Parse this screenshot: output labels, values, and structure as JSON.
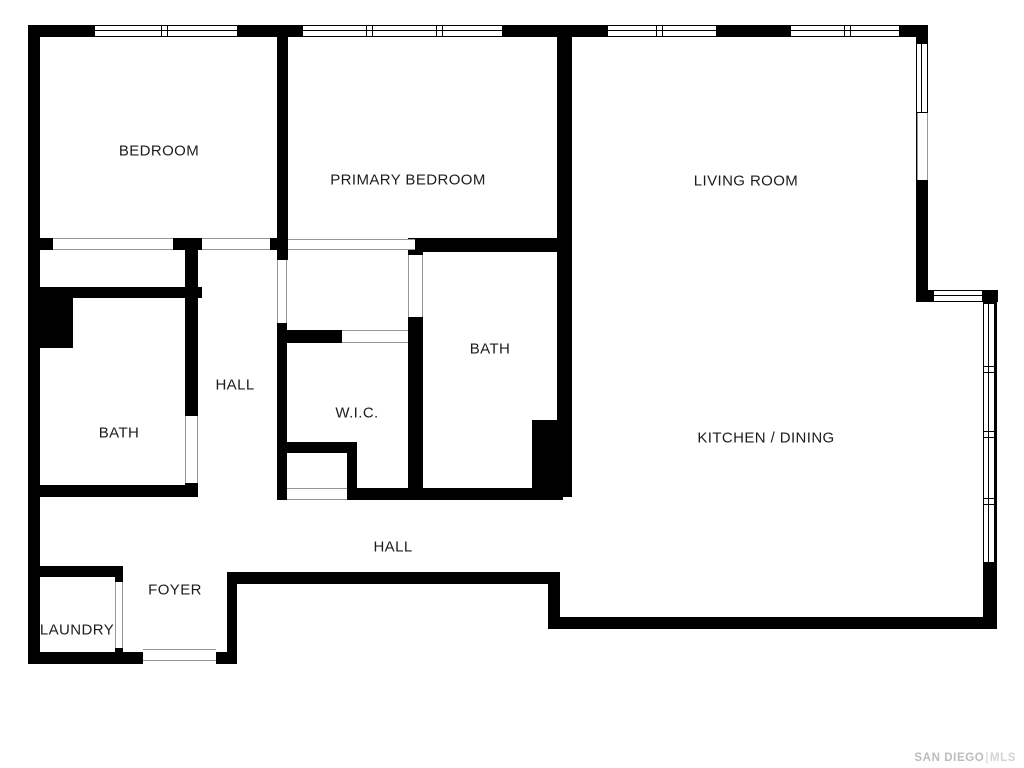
{
  "title": "Floor plan",
  "colors": {
    "wall": "#000000",
    "background": "#ffffff",
    "label_text": "#1c1c1c",
    "opening_line": "#979797",
    "watermark_brand": "#bcbcbc",
    "watermark_separator": "#cccccc",
    "watermark_suffix": "#d4d4d4"
  },
  "watermark": {
    "brand": "SAN DIEGO",
    "separator": "|",
    "suffix": "MLS"
  },
  "plan": {
    "width": 1024,
    "height": 768,
    "rooms": [
      {
        "name": "bedroom",
        "label": "BEDROOM",
        "cx": 159,
        "cy": 151
      },
      {
        "name": "primary-bedroom",
        "label": "PRIMARY BEDROOM",
        "cx": 408,
        "cy": 180
      },
      {
        "name": "living-room",
        "label": "LIVING ROOM",
        "cx": 746,
        "cy": 181
      },
      {
        "name": "bath-middle",
        "label": "BATH",
        "cx": 490,
        "cy": 349
      },
      {
        "name": "hall-upper",
        "label": "HALL",
        "cx": 235,
        "cy": 385
      },
      {
        "name": "wic",
        "label": "W.I.C.",
        "cx": 357,
        "cy": 413
      },
      {
        "name": "bath-left",
        "label": "BATH",
        "cx": 119,
        "cy": 433
      },
      {
        "name": "kitchen-dining",
        "label": "KITCHEN / DINING",
        "cx": 766,
        "cy": 438
      },
      {
        "name": "hall-lower",
        "label": "HALL",
        "cx": 393,
        "cy": 547
      },
      {
        "name": "foyer",
        "label": "FOYER",
        "cx": 175,
        "cy": 590
      },
      {
        "name": "laundry",
        "label": "LAUNDRY",
        "cx": 77,
        "cy": 630
      }
    ],
    "walls": [
      {
        "x": 28,
        "y": 25,
        "w": 900,
        "h": 12
      },
      {
        "x": 28,
        "y": 25,
        "w": 12,
        "h": 639
      },
      {
        "x": 916,
        "y": 25,
        "w": 12,
        "h": 268
      },
      {
        "x": 916,
        "y": 290,
        "w": 82,
        "h": 12
      },
      {
        "x": 983,
        "y": 290,
        "w": 14,
        "h": 339
      },
      {
        "x": 548,
        "y": 617,
        "w": 449,
        "h": 12
      },
      {
        "x": 548,
        "y": 572,
        "w": 12,
        "h": 57
      },
      {
        "x": 227,
        "y": 572,
        "w": 333,
        "h": 12
      },
      {
        "x": 227,
        "y": 572,
        "w": 10,
        "h": 92
      },
      {
        "x": 216,
        "y": 652,
        "w": 21,
        "h": 12
      },
      {
        "x": 28,
        "y": 652,
        "w": 115,
        "h": 12
      },
      {
        "x": 115,
        "y": 566,
        "w": 8,
        "h": 98
      },
      {
        "x": 28,
        "y": 566,
        "w": 95,
        "h": 11
      },
      {
        "x": 277,
        "y": 25,
        "w": 11,
        "h": 235
      },
      {
        "x": 28,
        "y": 238,
        "w": 260,
        "h": 12
      },
      {
        "x": 185,
        "y": 250,
        "w": 13,
        "h": 166
      },
      {
        "x": 185,
        "y": 483,
        "w": 13,
        "h": 14
      },
      {
        "x": 28,
        "y": 287,
        "w": 174,
        "h": 11
      },
      {
        "x": 28,
        "y": 287,
        "w": 45,
        "h": 61
      },
      {
        "x": 28,
        "y": 485,
        "w": 170,
        "h": 12
      },
      {
        "x": 277,
        "y": 323,
        "w": 10,
        "h": 175
      },
      {
        "x": 287,
        "y": 330,
        "w": 133,
        "h": 13
      },
      {
        "x": 287,
        "y": 442,
        "w": 70,
        "h": 11
      },
      {
        "x": 347,
        "y": 442,
        "w": 10,
        "h": 58
      },
      {
        "x": 277,
        "y": 488,
        "w": 286,
        "h": 12
      },
      {
        "x": 408,
        "y": 238,
        "w": 15,
        "h": 262
      },
      {
        "x": 415,
        "y": 238,
        "w": 155,
        "h": 14
      },
      {
        "x": 557,
        "y": 25,
        "w": 15,
        "h": 472
      },
      {
        "x": 532,
        "y": 420,
        "w": 25,
        "h": 77
      }
    ],
    "windows": [
      {
        "x": 94,
        "y": 25,
        "w": 144,
        "h": 12,
        "mullions": [
          69
        ]
      },
      {
        "x": 302,
        "y": 25,
        "w": 201,
        "h": 12,
        "mullions": [
          66,
          136
        ]
      },
      {
        "x": 607,
        "y": 25,
        "w": 110,
        "h": 12,
        "mullions": [
          51
        ]
      },
      {
        "x": 790,
        "y": 25,
        "w": 110,
        "h": 12,
        "mullions": [
          56
        ]
      },
      {
        "x": 916,
        "y": 43,
        "w": 12,
        "h": 70,
        "mullions": []
      },
      {
        "x": 933,
        "y": 290,
        "w": 50,
        "h": 12,
        "mullions": []
      },
      {
        "x": 983,
        "y": 303,
        "w": 12,
        "h": 260,
        "mullions": [
          65,
          130,
          197
        ]
      }
    ],
    "openings": [
      {
        "x": 53,
        "y": 238,
        "w": 120,
        "h": 12,
        "o": "h"
      },
      {
        "x": 202,
        "y": 238,
        "w": 68,
        "h": 12,
        "o": "h"
      },
      {
        "x": 288,
        "y": 239,
        "w": 127,
        "h": 11,
        "o": "h"
      },
      {
        "x": 277,
        "y": 260,
        "w": 10,
        "h": 63,
        "o": "v"
      },
      {
        "x": 408,
        "y": 255,
        "w": 15,
        "h": 62,
        "o": "v"
      },
      {
        "x": 342,
        "y": 330,
        "w": 66,
        "h": 13,
        "o": "h"
      },
      {
        "x": 185,
        "y": 416,
        "w": 13,
        "h": 67,
        "o": "v"
      },
      {
        "x": 287,
        "y": 488,
        "w": 60,
        "h": 12,
        "o": "h"
      },
      {
        "x": 115,
        "y": 582,
        "w": 8,
        "h": 66,
        "o": "v"
      },
      {
        "x": 143,
        "y": 649,
        "w": 73,
        "h": 12,
        "o": "h"
      },
      {
        "x": 917,
        "y": 113,
        "w": 11,
        "h": 67,
        "o": "v"
      }
    ]
  }
}
